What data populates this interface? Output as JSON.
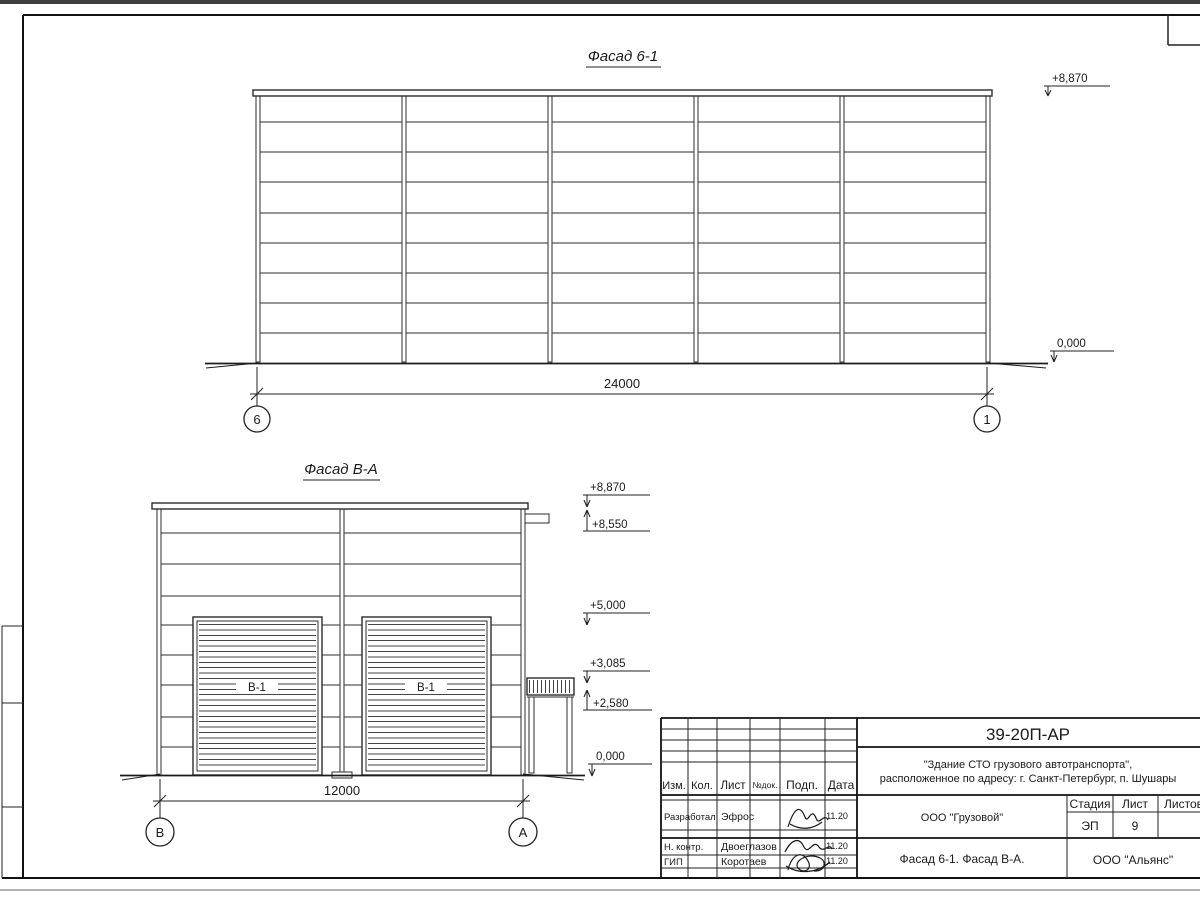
{
  "drawing": {
    "facade1": {
      "title": "Фасад 6-1",
      "dimension": "24000",
      "axis_left": "6",
      "axis_right": "1",
      "elev_top": "+8,870",
      "elev_zero": "0,000"
    },
    "facade2": {
      "title": "Фасад В-А",
      "dimension": "12000",
      "axis_left": "В",
      "axis_right": "А",
      "door_label": "В-1",
      "elev": {
        "roof": "+8,870",
        "parapet": "+8,550",
        "mid": "+5,000",
        "canopy_top": "+3,085",
        "canopy": "+2,580",
        "zero": "0,000"
      }
    }
  },
  "titleblock": {
    "code": "39-20П-АР",
    "object_line1": "\"Здание СТО грузового автотранспорта\",",
    "object_line2": "расположенное по адресу: г. Санкт-Петербург, п. Шушары",
    "client": "ООО \"Грузовой\"",
    "doc_title": "Фасад 6-1. Фасад В-А.",
    "company": "ООО \"Альянс\"",
    "stage_label": "Стадия",
    "list_label": "Лист",
    "listov_label": "Листов",
    "stage": "ЭП",
    "list_no": "9",
    "cols": {
      "izm": "Изм.",
      "kol": "Кол.",
      "list": "Лист",
      "ndok": "№док.",
      "podp": "Подп.",
      "data": "Дата"
    },
    "rows": [
      {
        "role": "Разработал",
        "name": "Эфрос",
        "date": "11.20"
      },
      {
        "role": "Н. контр.",
        "name": "Двоеглазов",
        "date": "11.20"
      },
      {
        "role": "ГИП",
        "name": "Коротаев",
        "date": "11.20"
      }
    ]
  }
}
